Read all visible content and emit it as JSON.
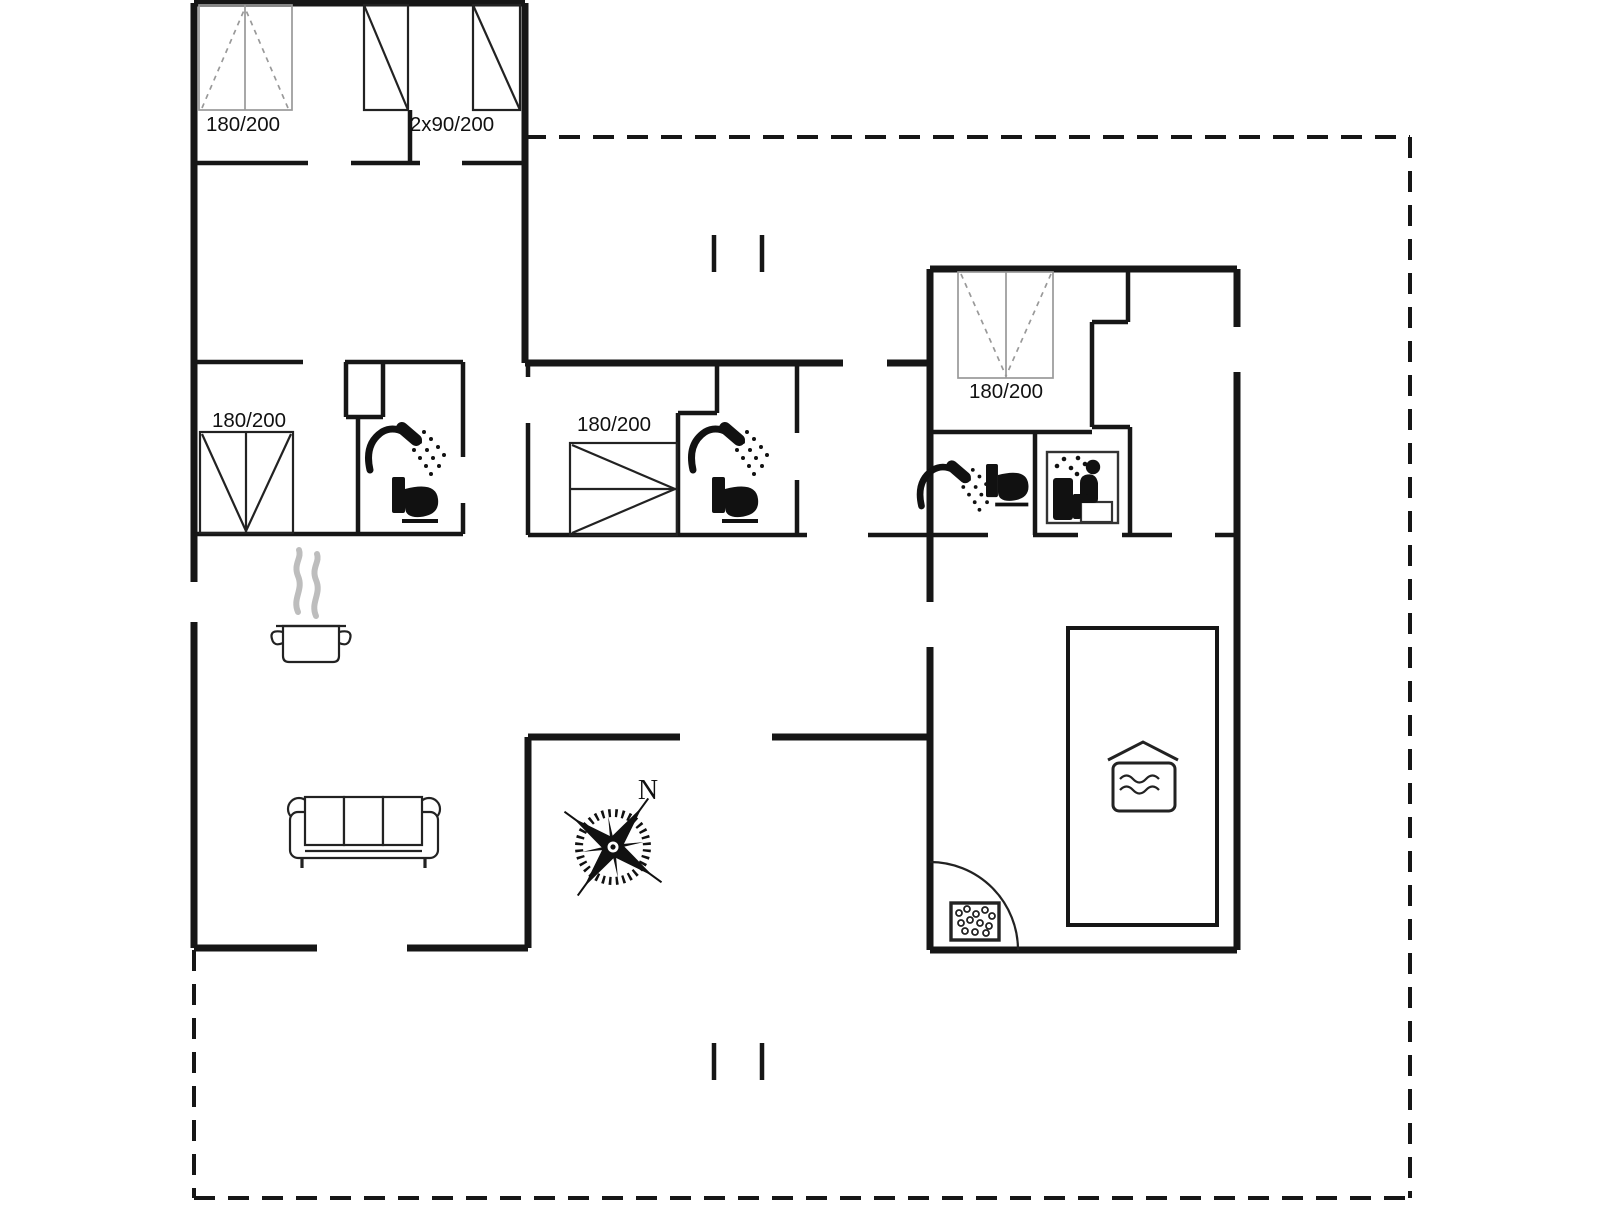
{
  "drawing": {
    "type": "house floor plan with surrounding terrace boundary"
  },
  "beds": {
    "top_left": {
      "label": "180/200"
    },
    "top_left_twin": {
      "label": "2x90/200"
    },
    "left": {
      "label": "180/200"
    },
    "middle": {
      "label": "180/200"
    },
    "right": {
      "label": "180/200"
    }
  },
  "compass": {
    "north_label": "N"
  },
  "icons": {
    "shower": "shower-head with spray",
    "toilet": "toilet side silhouette",
    "sauna": "sauna stove and seated person",
    "stove_pot": "steaming cooking pot (kitchen)",
    "sofa": "three-seat sofa",
    "compass_rose": "compass rose",
    "pool": "indoor swimming pool",
    "whirlpool": "whirlpool tub with bubbles",
    "door_arc": "door swing arc",
    "terrace_steps": "terrace step marks"
  },
  "colors": {
    "wall": "#161616",
    "furniture_line": "#222222",
    "light_bed_line": "#999999",
    "steam": "#bdbdbd",
    "background": "#ffffff"
  }
}
